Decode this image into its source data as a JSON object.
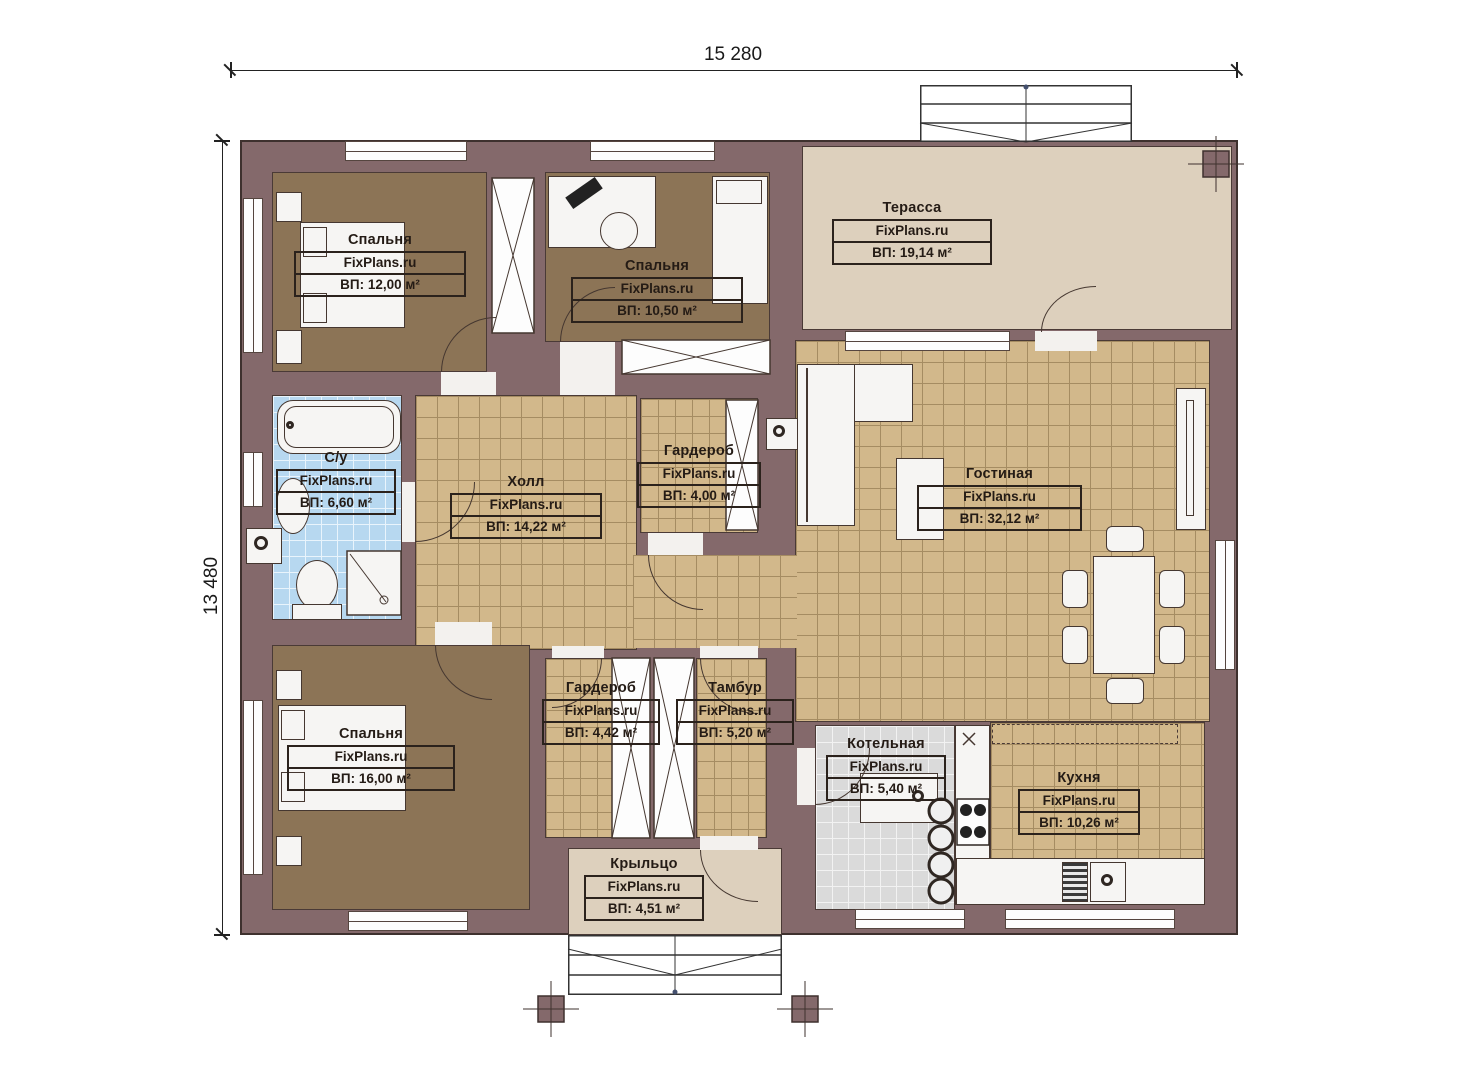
{
  "plan": {
    "width_label": "15 280",
    "height_label": "13 480"
  },
  "watermark": "FixPlans.ru",
  "rooms": {
    "bedroom1": {
      "name": "Спальня",
      "area": "ВП: 12,00 м²"
    },
    "bedroom2": {
      "name": "Спальня",
      "area": "ВП: 10,50 м²"
    },
    "terrace": {
      "name": "Терасса",
      "area": "ВП: 19,14 м²"
    },
    "bathroom": {
      "name": "С/у",
      "area": "ВП: 6,60 м²"
    },
    "hall": {
      "name": "Холл",
      "area": "ВП: 14,22 м²"
    },
    "wardrobe1": {
      "name": "Гардероб",
      "area": "ВП: 4,00 м²"
    },
    "living": {
      "name": "Гостиная",
      "area": "ВП: 32,12 м²"
    },
    "bedroom3": {
      "name": "Спальня",
      "area": "ВП: 16,00 м²"
    },
    "wardrobe2": {
      "name": "Гардероб",
      "area": "ВП: 4,42 м²"
    },
    "tambour": {
      "name": "Тамбур",
      "area": "ВП: 5,20 м²"
    },
    "boiler": {
      "name": "Котельная",
      "area": "ВП: 5,40 м²"
    },
    "kitchen": {
      "name": "Кухня",
      "area": "ВП: 10,26 м²"
    },
    "porch": {
      "name": "Крыльцо",
      "area": "ВП: 4,51 м²"
    }
  },
  "colors": {
    "wall": "#84696b",
    "wall_outline": "#3e312e",
    "tile_floor": "#d2b88b",
    "bedroom_floor": "#8c7456",
    "terrace_floor": "#ddd0bd",
    "bathroom_floor": "#b7d8f0",
    "boiler_floor": "#dadada",
    "furniture": "#f6f5f3"
  }
}
